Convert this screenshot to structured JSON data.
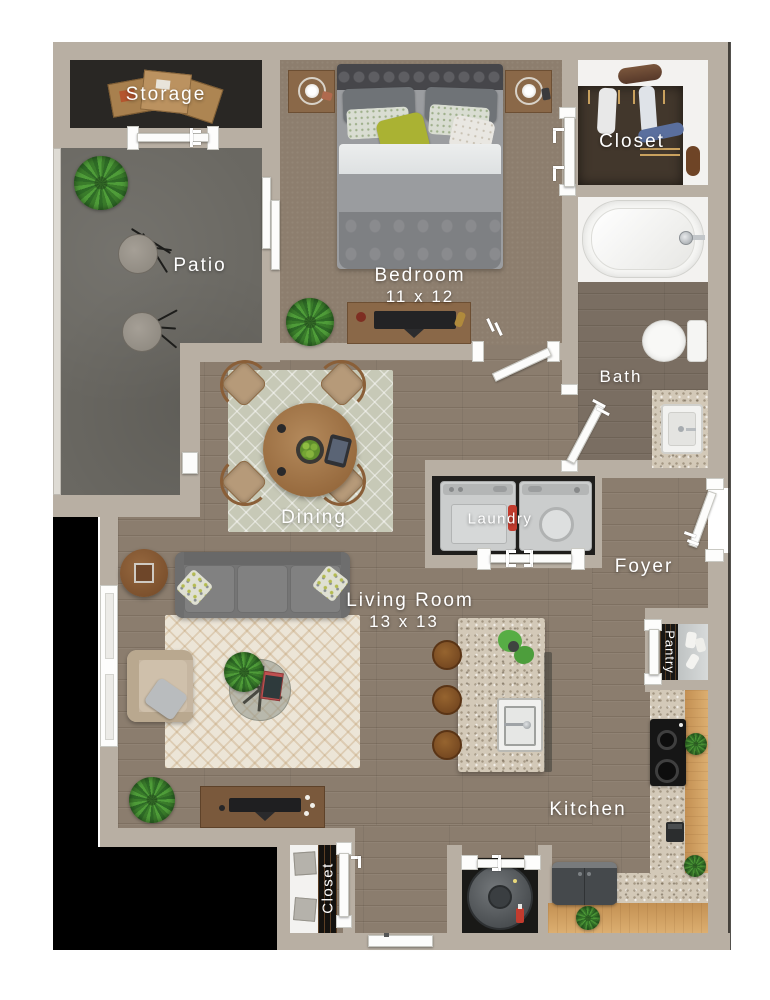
{
  "floorplan": {
    "rooms": {
      "storage": {
        "label": "Storage"
      },
      "patio": {
        "label": "Patio"
      },
      "bedroom": {
        "label": "Bedroom",
        "dimensions": "11 x 12"
      },
      "bedroom_closet": {
        "label": "Closet"
      },
      "bath": {
        "label": "Bath"
      },
      "dining": {
        "label": "Dining"
      },
      "laundry": {
        "label": "Laundry"
      },
      "foyer": {
        "label": "Foyer"
      },
      "living_room": {
        "label": "Living Room",
        "dimensions": "13 x 13"
      },
      "pantry": {
        "label": "Pantry"
      },
      "kitchen": {
        "label": "Kitchen"
      },
      "entry_closet": {
        "label": "Closet"
      }
    },
    "palette": {
      "wall": "#b8afa3",
      "wood_floor": "#8b7d6e",
      "bedroom_carpet": "#8d7e6e",
      "patio_concrete": "#6a6862",
      "storage_floor": "#292724",
      "granite_counter": "#d3c9b8",
      "cabinet_wood": "#cf9f5f",
      "accent_pillow_green": "#aab233",
      "label_text": "#ffffff"
    }
  }
}
